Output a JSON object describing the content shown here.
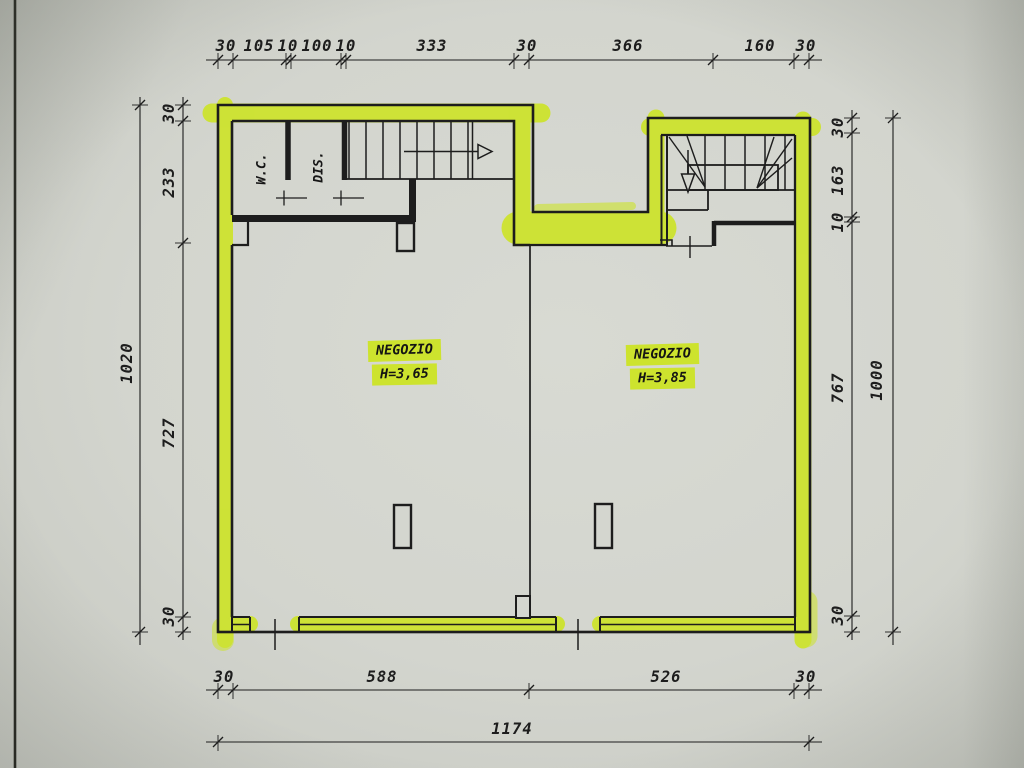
{
  "plan": {
    "rooms": [
      {
        "name": "NEGOZIO",
        "height": "H=3,65"
      },
      {
        "name": "NEGOZIO",
        "height": "H=3,85"
      }
    ],
    "service_rooms": [
      {
        "label": "W.C."
      },
      {
        "label": "DIS."
      }
    ],
    "dimensions": {
      "top": [
        "30",
        "105",
        "10",
        "100",
        "10",
        "333",
        "30",
        "366",
        "160",
        "30"
      ],
      "left_inner": [
        "30",
        "233",
        "727",
        "30"
      ],
      "left_outer": "1020",
      "right_inner": [
        "30",
        "163",
        "10",
        "767",
        "30"
      ],
      "right_outer": "1000",
      "bottom_inner": [
        "30",
        "588",
        "526",
        "30"
      ],
      "bottom_outer": "1174"
    },
    "colors": {
      "highlight": "#cde32e",
      "ink": "#1d1d1d",
      "paper": "#d4d6cf"
    }
  }
}
